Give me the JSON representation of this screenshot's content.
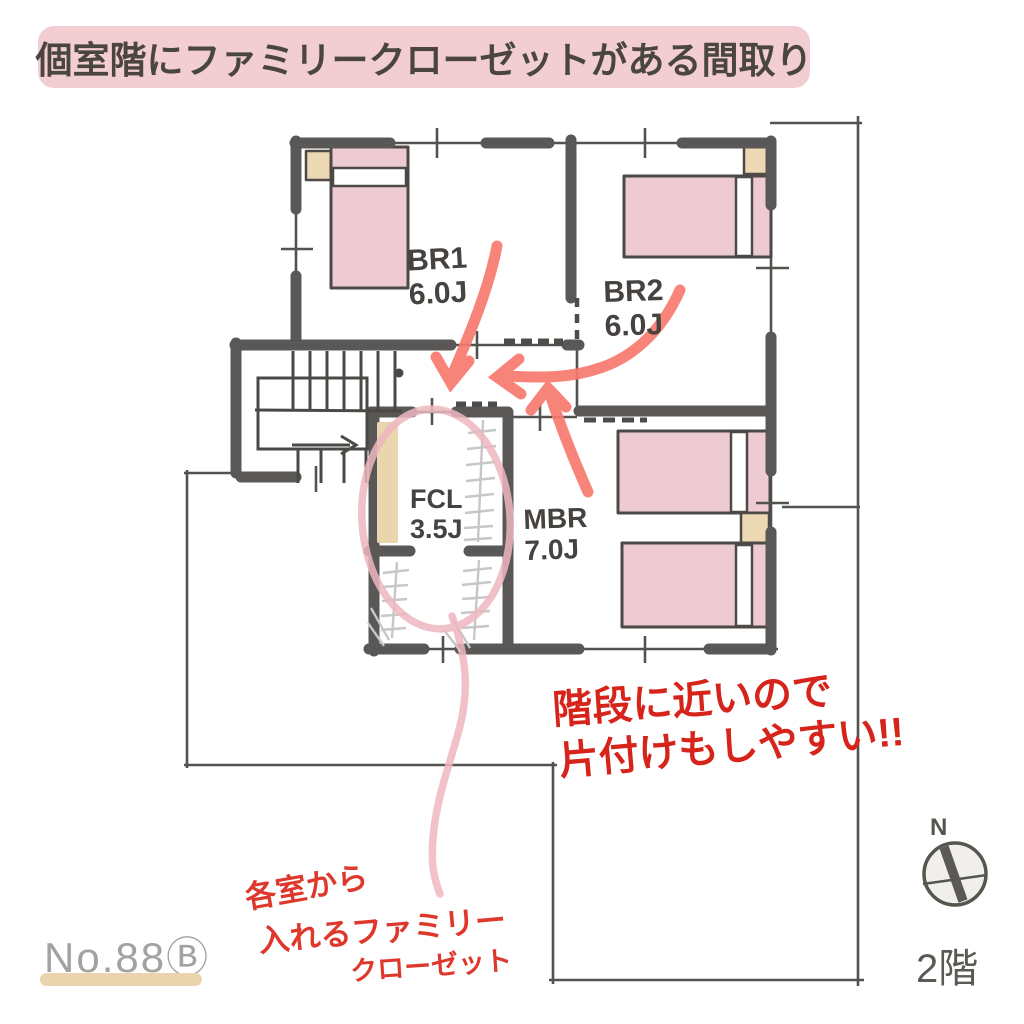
{
  "title": {
    "text": "個室階にファミリークローゼットがある間取り"
  },
  "rooms": {
    "br1": {
      "name": "BR1",
      "size": "6.0J"
    },
    "br2": {
      "name": "BR2",
      "size": "6.0J"
    },
    "fcl": {
      "name": "FCL",
      "size": "3.5J"
    },
    "mbr": {
      "name": "MBR",
      "size": "7.0J"
    }
  },
  "notes": {
    "stairs_note_line1": "階段に近いので",
    "stairs_note_line2": "片付けもしやすい!!",
    "closet_note_line1": "各室から",
    "closet_note_line2": "入れるファミリー",
    "closet_note_line3": "クローゼット"
  },
  "footer": {
    "plan_number": "No.88Ⓑ",
    "floor_label": "2階"
  },
  "compass": {
    "north_label": "N"
  },
  "colors": {
    "banner_pink": "#f2ced3",
    "wall_grey": "#5a5856",
    "bed_pink": "#eecad3",
    "pillow_beige": "#ecd8b2",
    "hanger_grey": "#c7c7c5",
    "highlight_red": "#d6241b",
    "note_red": "#de382c",
    "marker_salmon": "#f8796e",
    "circle_pink": "#efb7c0",
    "underline_tan": "#e9d4ad"
  }
}
